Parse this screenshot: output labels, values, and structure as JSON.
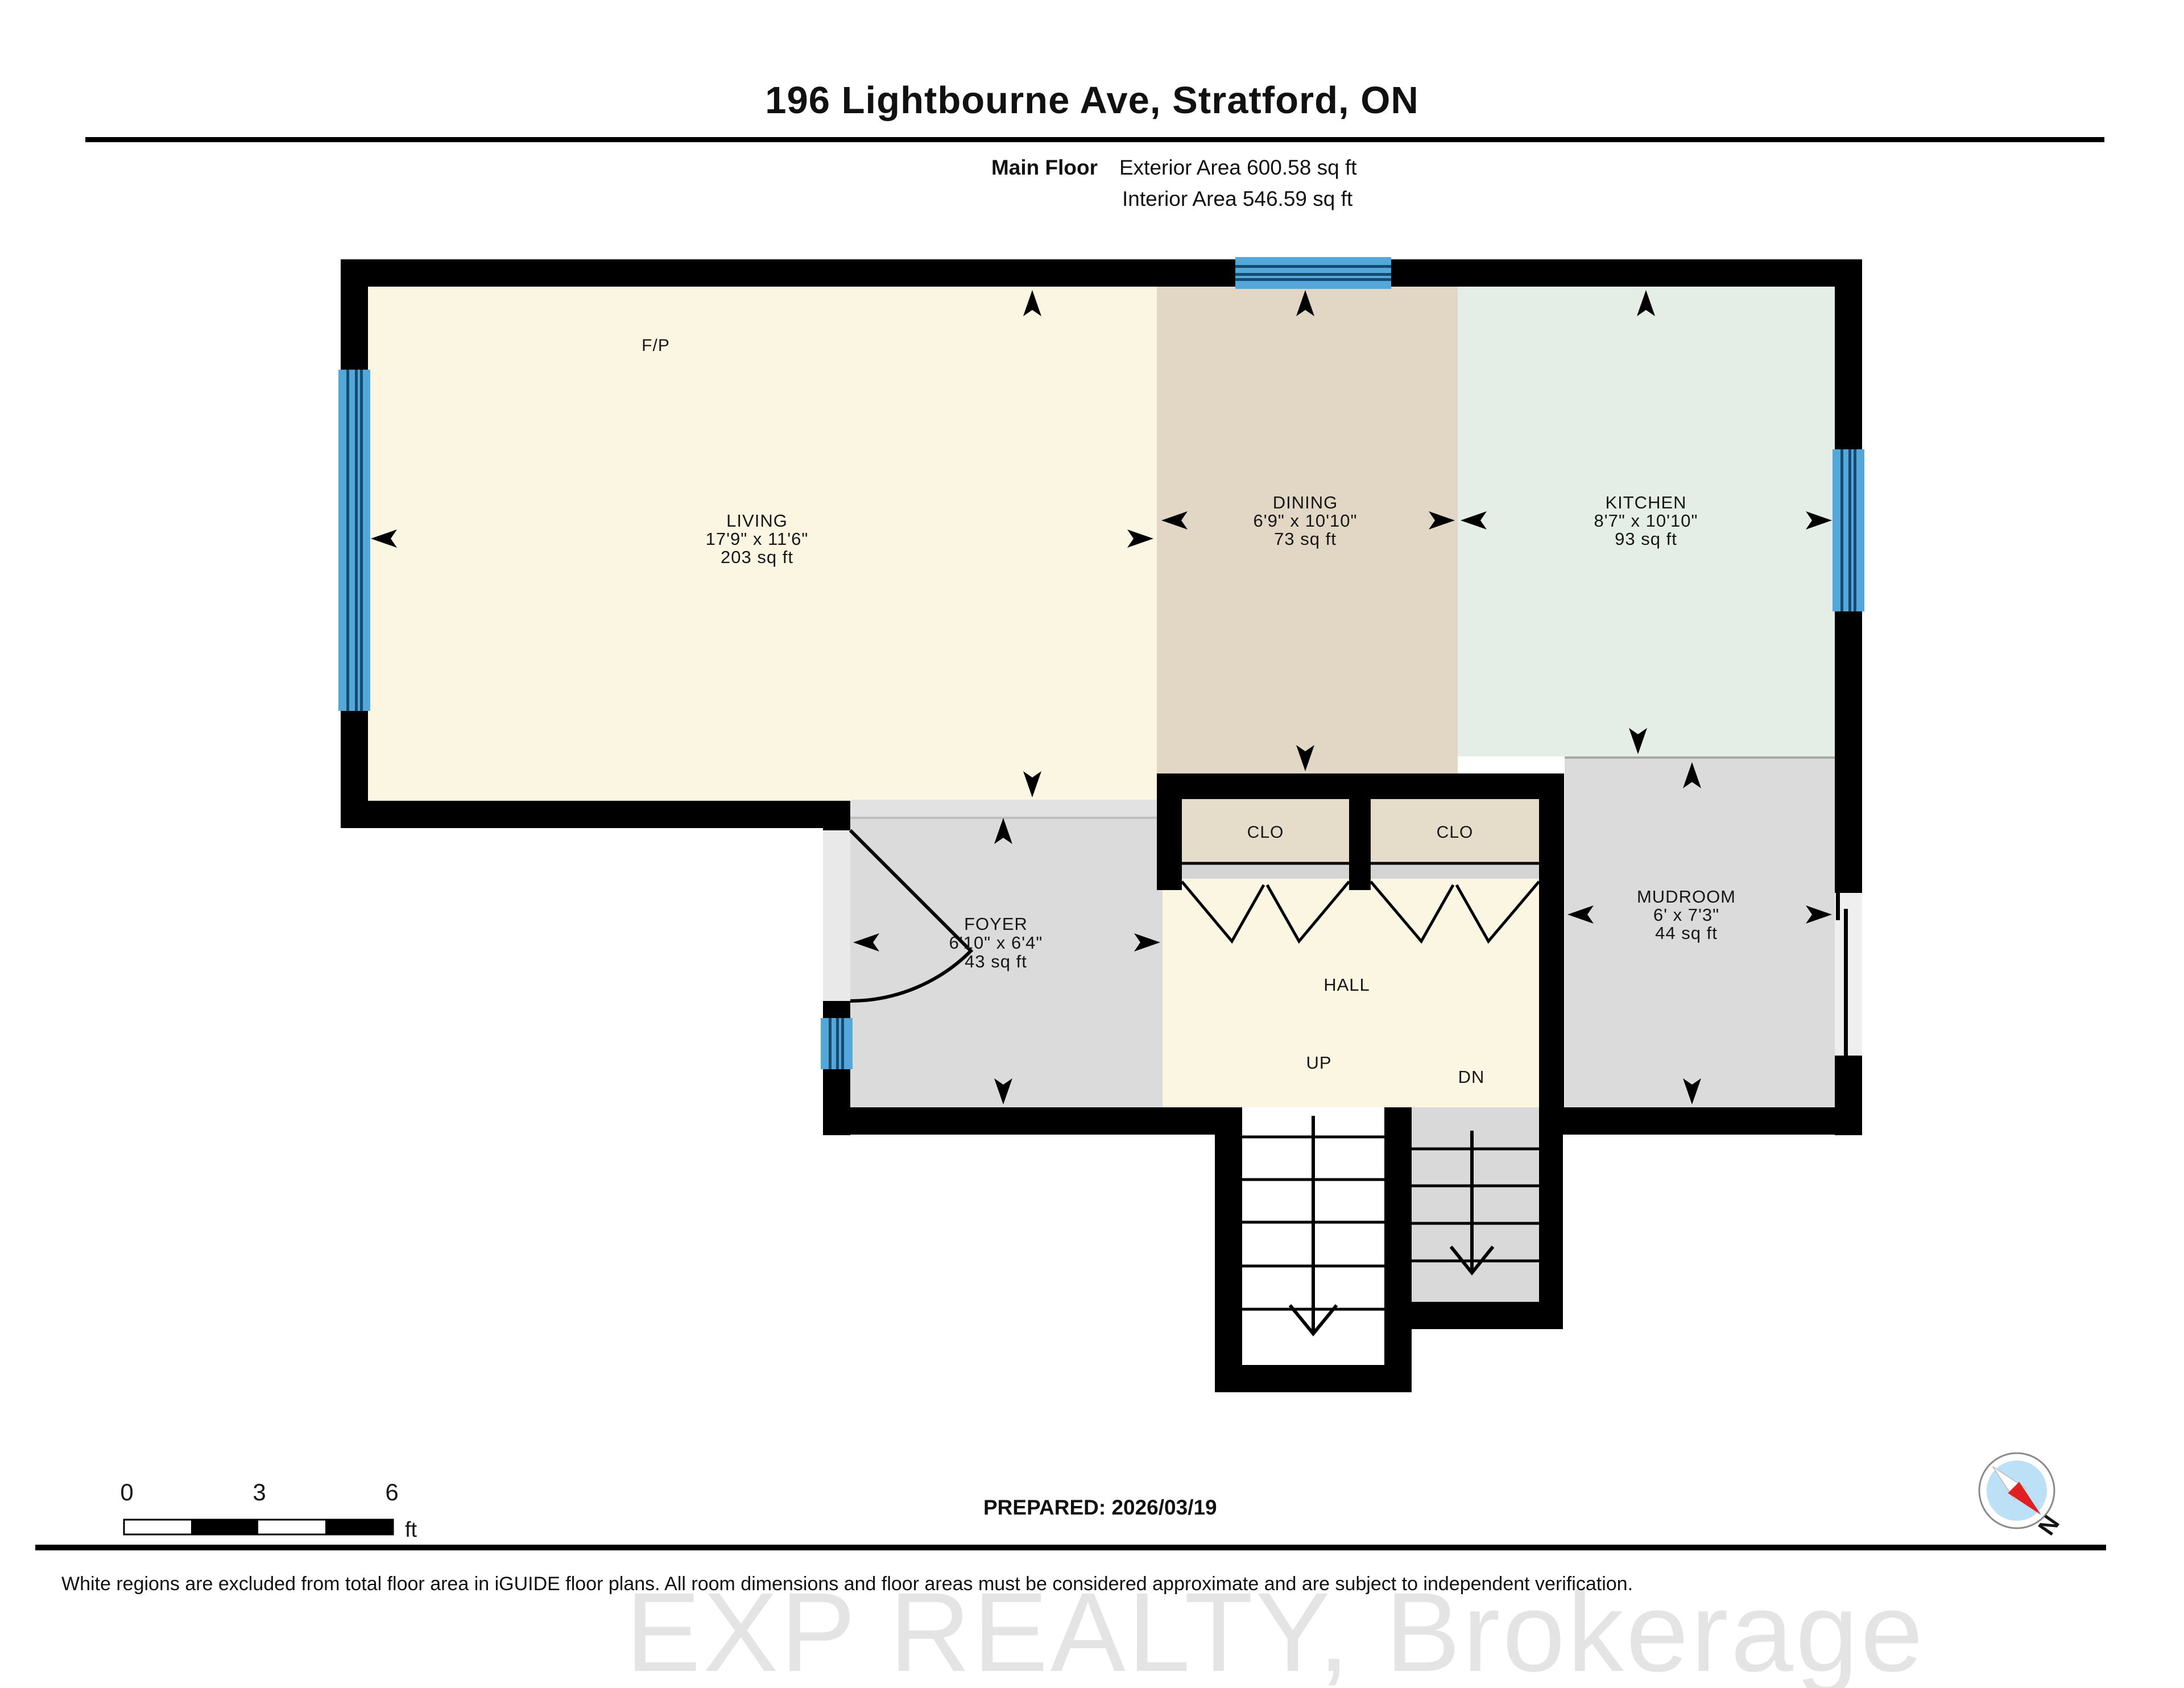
{
  "header": {
    "title": "196 Lightbourne Ave, Stratford, ON",
    "floor_label": "Main Floor",
    "exterior_area": "Exterior Area 600.58 sq ft",
    "interior_area": "Interior Area 546.59 sq ft"
  },
  "rooms": {
    "living": {
      "name": "LIVING",
      "dims": "17'9\" x 11'6\"",
      "area": "203 sq ft"
    },
    "dining": {
      "name": "DINING",
      "dims": "6'9\" x 10'10\"",
      "area": "73 sq ft"
    },
    "kitchen": {
      "name": "KITCHEN",
      "dims": "8'7\" x 10'10\"",
      "area": "93 sq ft"
    },
    "foyer": {
      "name": "FOYER",
      "dims": "6'10\" x 6'4\"",
      "area": "43 sq ft"
    },
    "mudroom": {
      "name": "MUDROOM",
      "dims": "6' x 7'3\"",
      "area": "44 sq ft"
    },
    "hall": {
      "name": "HALL"
    },
    "closet1": {
      "name": "CLO"
    },
    "closet2": {
      "name": "CLO"
    },
    "fireplace": {
      "name": "F/P"
    },
    "stairs_up": {
      "name": "UP"
    },
    "stairs_down": {
      "name": "DN"
    }
  },
  "scale_bar": {
    "tick0": "0",
    "tick1": "3",
    "tick2": "6",
    "unit": "ft"
  },
  "compass": {
    "label": "N"
  },
  "footer": {
    "prepared": "PREPARED: 2026/03/19",
    "disclaimer": "White regions are excluded from total floor area in iGUIDE floor plans. All room dimensions and floor areas must be considered approximate and are subject to independent verification.",
    "watermark": "EXP REALTY, Brokerage"
  },
  "colors": {
    "wall": "#000000",
    "living_fill": "#FBF6E2",
    "dining_fill": "#E1D7C4",
    "kitchen_fill": "#E4EEE7",
    "closet_fill": "#E6DCCA",
    "gray_fill": "#DBDBDB",
    "window_blue": "#54A7DA",
    "window_stripe": "#174A6F",
    "compass_disc": "#BCE0F5",
    "compass_needle_red": "#E02020"
  }
}
